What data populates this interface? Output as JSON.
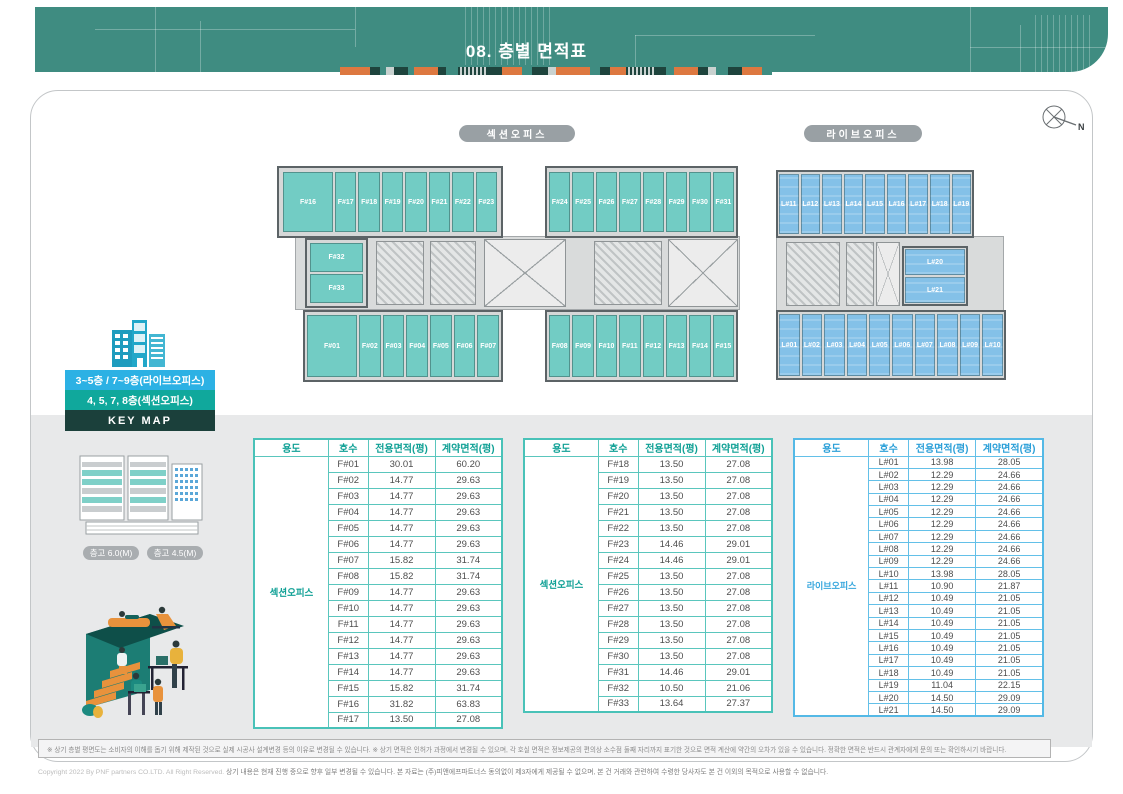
{
  "header": {
    "title": "08. 층별 면적표",
    "strip_segments": [
      {
        "c": "#dd7840",
        "w": 30
      },
      {
        "c": "#1e443d",
        "w": 10
      },
      {
        "c": "#3f8c81",
        "w": 6
      },
      {
        "c": "#c9d2d0",
        "w": 8
      },
      {
        "c": "#1e443d",
        "w": 14
      },
      {
        "c": "#3f8c81",
        "w": 6
      },
      {
        "c": "#dd7840",
        "w": 24
      },
      {
        "c": "#1e443d",
        "w": 8
      },
      {
        "c": "#3f8c81",
        "w": 12
      },
      {
        "c": "stripes",
        "w": 30
      },
      {
        "c": "#1e443d",
        "w": 14
      },
      {
        "c": "#dd7840",
        "w": 20
      },
      {
        "c": "#3f8c81",
        "w": 10
      },
      {
        "c": "#1e443d",
        "w": 16
      },
      {
        "c": "#c9d2d0",
        "w": 8
      },
      {
        "c": "#dd7840",
        "w": 34
      },
      {
        "c": "#3f8c81",
        "w": 10
      },
      {
        "c": "#1e443d",
        "w": 10
      },
      {
        "c": "#dd7840",
        "w": 16
      },
      {
        "c": "stripes",
        "w": 28
      },
      {
        "c": "#1e443d",
        "w": 12
      },
      {
        "c": "#3f8c81",
        "w": 8
      },
      {
        "c": "#dd7840",
        "w": 24
      },
      {
        "c": "#1e443d",
        "w": 10
      },
      {
        "c": "#c9d2d0",
        "w": 8
      },
      {
        "c": "#3f8c81",
        "w": 12
      },
      {
        "c": "#1e443d",
        "w": 14
      },
      {
        "c": "#dd7840",
        "w": 20
      },
      {
        "c": "#3f8c81",
        "w": 10
      }
    ]
  },
  "plan_labels": {
    "section": "섹션오피스",
    "live": "라이브오피스"
  },
  "compass": {
    "label": "N"
  },
  "floorplans": {
    "section": {
      "top_left_units": [
        "F#16",
        "F#17",
        "F#18",
        "F#19",
        "F#20",
        "F#21",
        "F#22",
        "F#23"
      ],
      "top_right_units": [
        "F#24",
        "F#25",
        "F#26",
        "F#27",
        "F#28",
        "F#29",
        "F#30",
        "F#31"
      ],
      "mid_units": [
        "F#32",
        "F#33"
      ],
      "bottom_left_units": [
        "F#01",
        "F#02",
        "F#03",
        "F#04",
        "F#05",
        "F#06",
        "F#07"
      ],
      "bottom_right_units": [
        "F#08",
        "F#09",
        "F#10",
        "F#11",
        "F#12",
        "F#13",
        "F#14",
        "F#15"
      ]
    },
    "live": {
      "top_units": [
        "L#11",
        "L#12",
        "L#13",
        "L#14",
        "L#15",
        "L#16",
        "L#17",
        "L#18",
        "L#19"
      ],
      "mid_units": [
        "L#20",
        "L#21"
      ],
      "bottom_units": [
        "L#01",
        "L#02",
        "L#03",
        "L#04",
        "L#05",
        "L#06",
        "L#07",
        "L#08",
        "L#09",
        "L#10"
      ]
    }
  },
  "keymap": {
    "band_live": "3~5층 / 7~9층(라이브오피스)",
    "band_section": "4, 5, 7, 8층(섹션오피스)",
    "band_keymap": "KEY MAP",
    "height_pill_1": "층고 6.0(M)",
    "height_pill_2": "층고 4.5(M)"
  },
  "tables": [
    {
      "usage": "섹션오피스",
      "headers": [
        "용도",
        "호수",
        "전용면적(평)",
        "계약면적(평)"
      ],
      "rows": [
        [
          "F#01",
          "30.01",
          "60.20"
        ],
        [
          "F#02",
          "14.77",
          "29.63"
        ],
        [
          "F#03",
          "14.77",
          "29.63"
        ],
        [
          "F#04",
          "14.77",
          "29.63"
        ],
        [
          "F#05",
          "14.77",
          "29.63"
        ],
        [
          "F#06",
          "14.77",
          "29.63"
        ],
        [
          "F#07",
          "15.82",
          "31.74"
        ],
        [
          "F#08",
          "15.82",
          "31.74"
        ],
        [
          "F#09",
          "14.77",
          "29.63"
        ],
        [
          "F#10",
          "14.77",
          "29.63"
        ],
        [
          "F#11",
          "14.77",
          "29.63"
        ],
        [
          "F#12",
          "14.77",
          "29.63"
        ],
        [
          "F#13",
          "14.77",
          "29.63"
        ],
        [
          "F#14",
          "14.77",
          "29.63"
        ],
        [
          "F#15",
          "15.82",
          "31.74"
        ],
        [
          "F#16",
          "31.82",
          "63.83"
        ],
        [
          "F#17",
          "13.50",
          "27.08"
        ]
      ]
    },
    {
      "usage": "섹션오피스",
      "headers": [
        "용도",
        "호수",
        "전용면적(평)",
        "계약면적(평)"
      ],
      "rows": [
        [
          "F#18",
          "13.50",
          "27.08"
        ],
        [
          "F#19",
          "13.50",
          "27.08"
        ],
        [
          "F#20",
          "13.50",
          "27.08"
        ],
        [
          "F#21",
          "13.50",
          "27.08"
        ],
        [
          "F#22",
          "13.50",
          "27.08"
        ],
        [
          "F#23",
          "14.46",
          "29.01"
        ],
        [
          "F#24",
          "14.46",
          "29.01"
        ],
        [
          "F#25",
          "13.50",
          "27.08"
        ],
        [
          "F#26",
          "13.50",
          "27.08"
        ],
        [
          "F#27",
          "13.50",
          "27.08"
        ],
        [
          "F#28",
          "13.50",
          "27.08"
        ],
        [
          "F#29",
          "13.50",
          "27.08"
        ],
        [
          "F#30",
          "13.50",
          "27.08"
        ],
        [
          "F#31",
          "14.46",
          "29.01"
        ],
        [
          "F#32",
          "10.50",
          "21.06"
        ],
        [
          "F#33",
          "13.64",
          "27.37"
        ]
      ]
    },
    {
      "usage": "라이브오피스",
      "headers": [
        "용도",
        "호수",
        "전용면적(평)",
        "계약면적(평)"
      ],
      "rows": [
        [
          "L#01",
          "13.98",
          "28.05"
        ],
        [
          "L#02",
          "12.29",
          "24.66"
        ],
        [
          "L#03",
          "12.29",
          "24.66"
        ],
        [
          "L#04",
          "12.29",
          "24.66"
        ],
        [
          "L#05",
          "12.29",
          "24.66"
        ],
        [
          "L#06",
          "12.29",
          "24.66"
        ],
        [
          "L#07",
          "12.29",
          "24.66"
        ],
        [
          "L#08",
          "12.29",
          "24.66"
        ],
        [
          "L#09",
          "12.29",
          "24.66"
        ],
        [
          "L#10",
          "13.98",
          "28.05"
        ],
        [
          "L#11",
          "10.90",
          "21.87"
        ],
        [
          "L#12",
          "10.49",
          "21.05"
        ],
        [
          "L#13",
          "10.49",
          "21.05"
        ],
        [
          "L#14",
          "10.49",
          "21.05"
        ],
        [
          "L#15",
          "10.49",
          "21.05"
        ],
        [
          "L#16",
          "10.49",
          "21.05"
        ],
        [
          "L#17",
          "10.49",
          "21.05"
        ],
        [
          "L#18",
          "10.49",
          "21.05"
        ],
        [
          "L#19",
          "11.04",
          "22.15"
        ],
        [
          "L#20",
          "14.50",
          "29.09"
        ],
        [
          "L#21",
          "14.50",
          "29.09"
        ]
      ]
    }
  ],
  "footnote": "※ 상기 층별 평면도는 소비자의 이해를 돕기 위해 제작된 것으로 실제 시공사 설계변경 등의 이유로 변경될 수 있습니다. ※ 상기 면적은 인허가 과정에서 변경될 수 있으며, 각 호실 면적은 정보제공의 편의상 소수점 둘째 자리까지 표기한 것으로 면적 계산에 약간의 오차가 있을 수 있습니다. 정확한 면적은 반드시 관계자에게 문의 또는 확인하시기 바랍니다.",
  "copyright_light": "Copyright 2022 By PNF partners CO.LTD. All Right Reserved.",
  "copyright_dark": "상기 내용은 현재 진행 중으로 향후 일부 변경될 수 있습니다. 본 자료는 (주)피앤에프파트너스 동의없이 제3자에게 제공될 수 없으며, 본 건 거래와 관련하여 수령한 당사자도 본 건 이외의 목적으로 사용할 수 없습니다.",
  "colors": {
    "banner_teal": "#3f8c81",
    "section_unit": "#72ccc4",
    "live_unit": "#84c1e8",
    "accent_orange": "#dd7840",
    "table_teal": "#49c2b8",
    "table_blue": "#54b9e6"
  }
}
